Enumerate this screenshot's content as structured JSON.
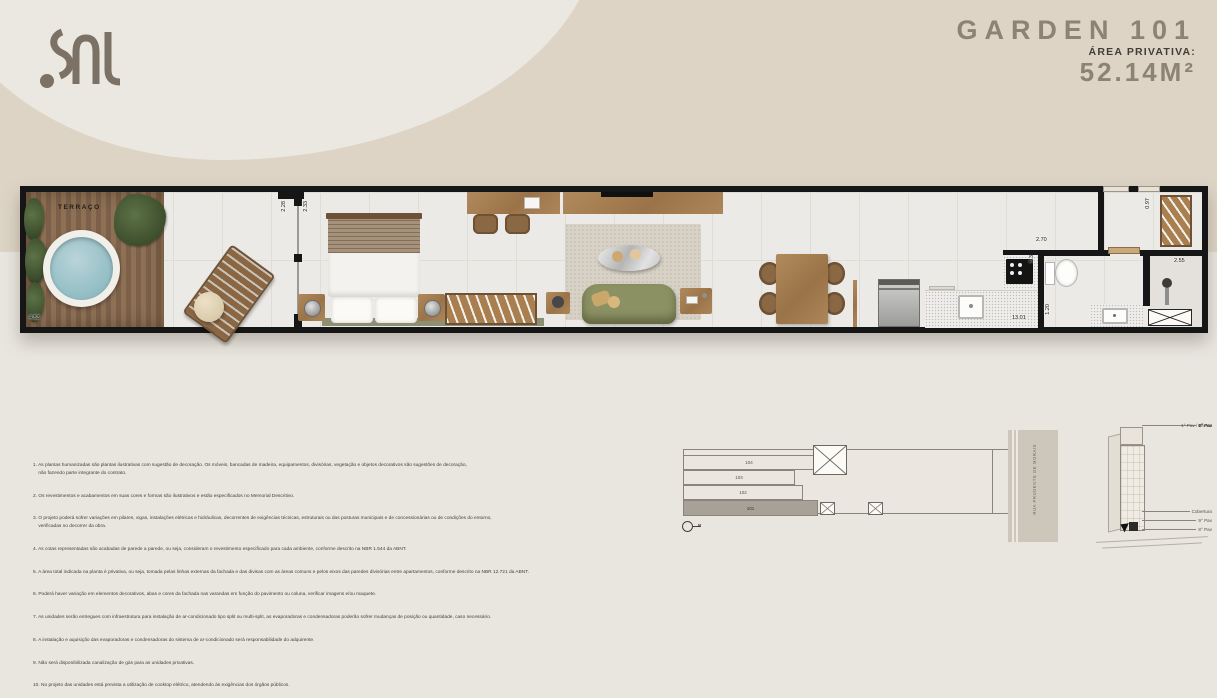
{
  "brand": {
    "logo_name": "sal-logo"
  },
  "header": {
    "title": "GARDEN 101",
    "area_label": "ÁREA PRIVATIVA:",
    "area_value": "52.14M²"
  },
  "plan": {
    "room_label": "TERRAÇO",
    "dims": {
      "terrace": "4.53",
      "door_a": "2.28",
      "door_b": "2.33",
      "kitchen_w": "2.70",
      "kitchen_d": "1.35",
      "length": "13.01",
      "bath": "1.20",
      "shower": "2.55",
      "entry": "0.97"
    }
  },
  "notes": [
    "1. As plantas humanizadas são plantas ilustrativas com sugestão de decoração. Os móveis, bancadas de madeira, equipamentos, divisórias, vegetação e objetos decorativos são sugestões de decoração,\n    não fazendo parte integrante do contrato.",
    "2. Os revestimentos e acabamentos em suas cores e formas são ilustrativos e estão especificados no Memorial Descritivo.",
    "3. O projeto poderá sofrer variações em pilares, vigas, instalações elétricas e hidráulicas, decorrentes de exigências técnicas, estruturais ou das posturas municipais e de concessionárias ou de condições do entorno,\n    verificadas no decorrer da obra.",
    "4. As cotas representadas são acabadas de parede a parede, ou seja, consideram o revestimento especificado para cada ambiente, conforme descrito na NBR 1.544 da ABNT.",
    "5. A área total indicada na planta é privativa, ou seja, tomada pelas linhas externas da fachada e das divisas com as áreas comuns e pelos eixos das paredes divisórias entre apartamentos, conforme descrito na NBR 12.721 da ABNT.",
    "6. Poderá haver variação em elementos decorativos, abas e cores da fachada nas varandas em função do pavimento ou coluna, verificar imagens e/ou maquete.",
    "7. As unidades serão entregues com infraestrutura para instalação de ar-condicionado tipo split ou multi-split, as evaporadoras e condensadoras poderão sofrer mudanças de posição ou quantidade, caso necessário.",
    "8. A instalação e aquisição das evaporadoras e condensadoras do sistema de ar-condicionado será responsabilidade do adquirente.",
    "9. Não será disponibilizada canalização de gás para as unidades privativas.",
    "10. No projeto das unidades está prevista a utilização de cooktop elétrico, atendendo às exigências dos órgãos públicos."
  ],
  "site_plan": {
    "units": [
      "104",
      "103",
      "102",
      "101"
    ],
    "highlighted_unit": "101",
    "street": "RUA PRUDENTE DE MORAIS",
    "north_label": "N"
  },
  "elevation": {
    "floors": [
      "Cobertura",
      "9° Pav",
      "8° Pav",
      "7° Pav",
      "6° Pav",
      "5° Pav",
      "4° Pav",
      "3° Pav",
      "2° Pav",
      "1° Pav / Térreo"
    ]
  },
  "colors": {
    "background_beige": "#ddd4c6",
    "background_light": "#ebe8e2",
    "title_text": "#8c8275",
    "wall": "#161616",
    "wood": "#a57f52",
    "pool_water": "#97c0c7",
    "sofa_green": "#8b9162"
  }
}
